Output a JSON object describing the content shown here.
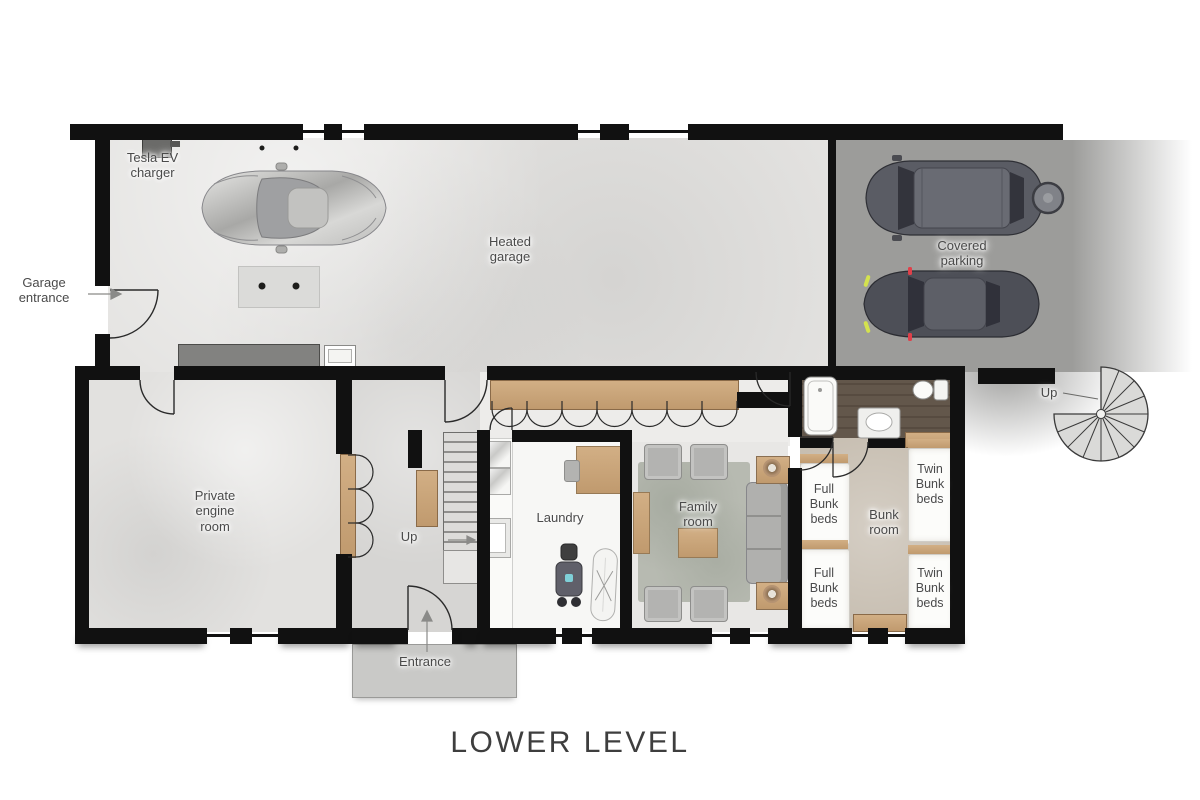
{
  "title": "LOWER LEVEL",
  "labels": {
    "tesla_charger": "Tesla EV\ncharger",
    "garage_entrance": "Garage\nentrance",
    "heated_garage": "Heated\ngarage",
    "covered_parking": "Covered\nparking",
    "spiral_stairs_up": "Up",
    "private_engine_room": "Private\nengine\nroom",
    "hall_stairs_up": "Up",
    "laundry": "Laundry",
    "family_room": "Family\nroom",
    "bunk_room": "Bunk\nroom",
    "full_bunk_beds_upper": "Full\nBunk\nbeds",
    "full_bunk_beds_lower": "Full\nBunk\nbeds",
    "twin_bunk_beds_upper": "Twin\nBunk\nbeds",
    "twin_bunk_beds_lower": "Twin\nBunk\nbeds",
    "entrance": "Entrance"
  },
  "colors": {
    "wall": "#111111",
    "garage_floor": "#e4e3e1",
    "parking_floor": "#9c9c9a",
    "hall_floor": "#d6d5d3",
    "laundry_floor": "#f7f7f5",
    "family_floor": "#e8e7e5",
    "bunk_floor": "#c7beb1",
    "bathroom_floor": "#5e5247",
    "closet_wood": "#c8a57e",
    "label_text": "#4a4a4a",
    "title_text": "#3e3e3e"
  }
}
